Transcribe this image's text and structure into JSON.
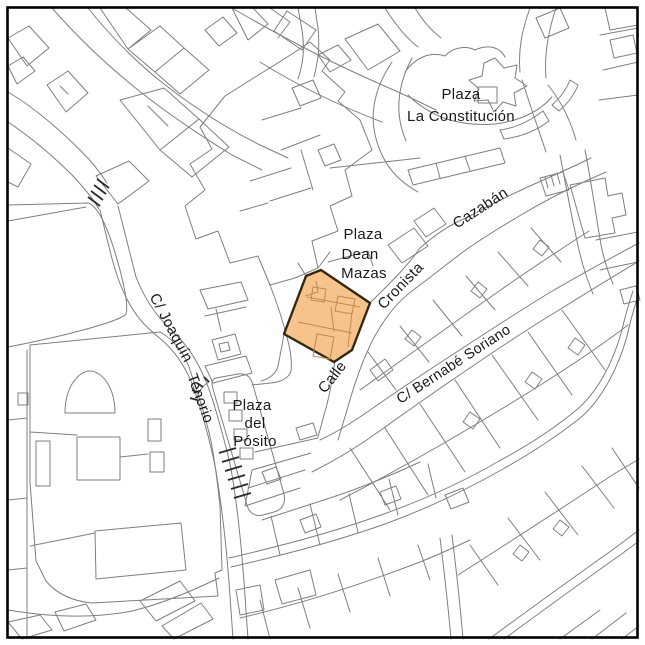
{
  "map": {
    "description": "Cadastral street map with one highlighted building parcel",
    "colors": {
      "background": "#ffffff",
      "frame": "#000000",
      "parcel_line": "#7f7f7f",
      "label_text": "#1a1a1a",
      "highlight_fill": "#f6c38d",
      "highlight_stroke": "#33270f",
      "highlight_inner_line": "#b98c52",
      "stairs_dark": "#2a2a2a"
    },
    "labels": {
      "plaza_constitucion": {
        "line1": "Plaza",
        "line2": "La Constitución"
      },
      "plaza_dean_mazas": {
        "line1": "Plaza",
        "line2": "Dean",
        "line3": "Mazas"
      },
      "calle_cronista_cazaban": {
        "word1": "Calle",
        "word2": "Cronista",
        "word3": "Cazabán"
      },
      "bernabe_soriano": {
        "text": "C/ Bernabé Soriano"
      },
      "joaquin_tenorio": {
        "part1": "C/ Joaquín",
        "part2": "Tenorio"
      },
      "plaza_posito": {
        "line1": "Plaza",
        "line2": "del",
        "line3": "Pósito"
      }
    },
    "highlight": {
      "name": "Highlighted building parcel"
    }
  }
}
